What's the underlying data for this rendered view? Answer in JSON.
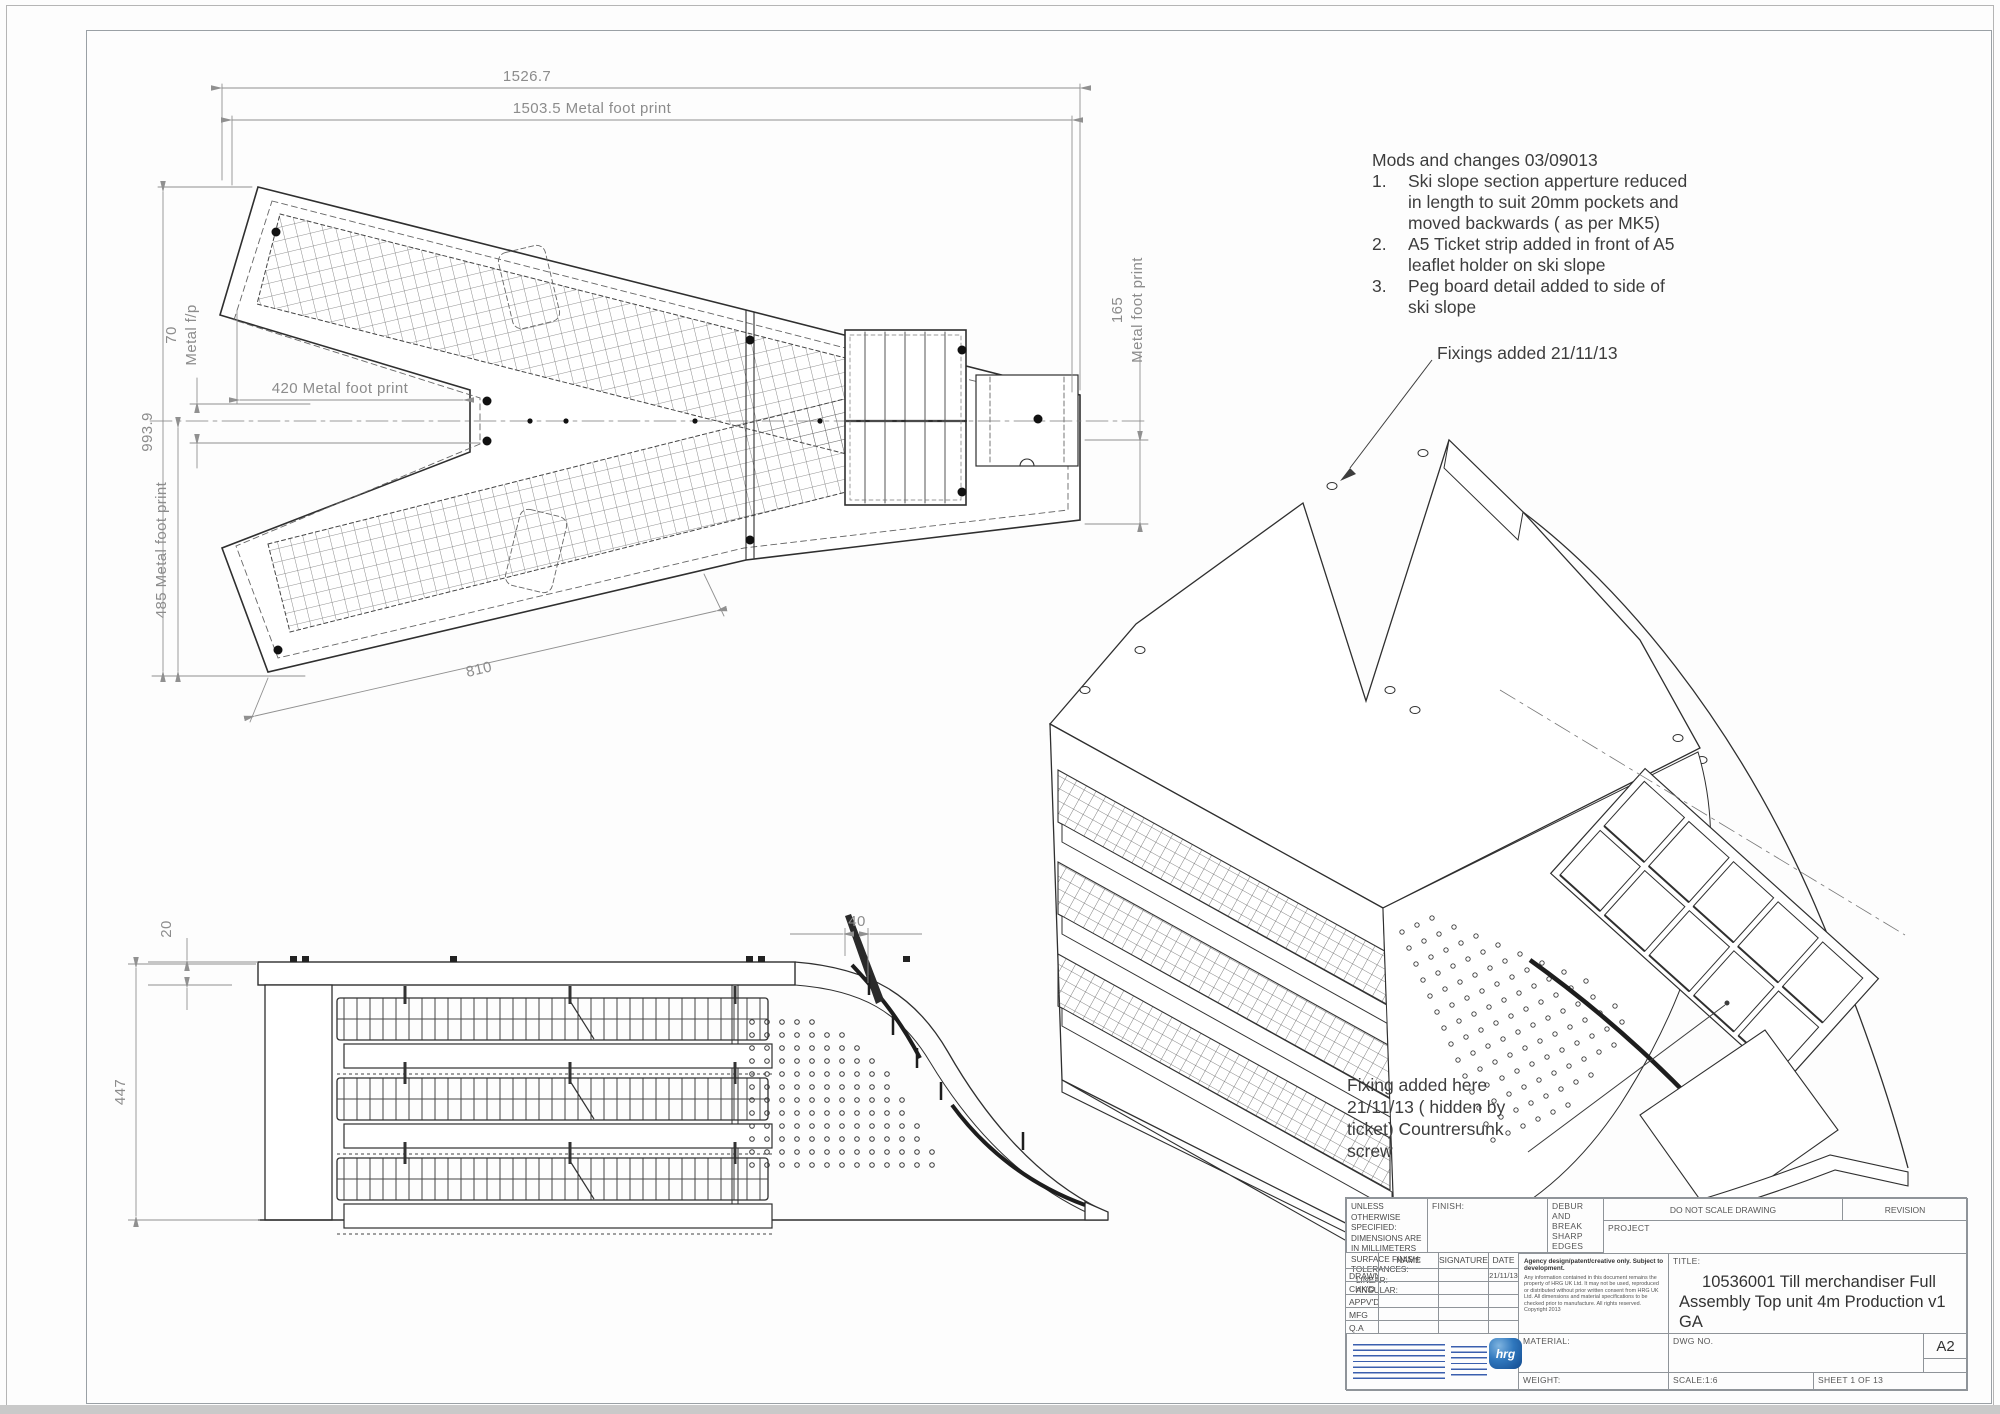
{
  "notes": {
    "title": "Mods and changes 03/09013",
    "items": [
      {
        "n": "1.",
        "text": "Ski slope section apperture reduced in length to suit 20mm pockets and moved backwards ( as per MK5)"
      },
      {
        "n": "2.",
        "text": "A5 Ticket strip added in front of A5 leaflet holder on ski slope"
      },
      {
        "n": "3.",
        "text": "Peg board detail added to side of ski slope"
      }
    ]
  },
  "iso_annotations": {
    "fixings_added": "Fixings added 21/11/13",
    "fixing_added_here_lines": [
      "Fixing added here",
      "21/11/13 ( hidden by",
      "ticket) Countrersunk",
      "screw"
    ]
  },
  "plan_dims": {
    "overall_width": "1526.7",
    "footprint_width": "1503.5 Metal foot print",
    "overall_height": "993.9",
    "notch_offset": "70",
    "notch_offset_unit": "Metal f/p",
    "notch_depth": "420  Metal foot print",
    "arm_footprint": "485 Metal foot print",
    "arm_length": "810",
    "right_width": "165",
    "right_width_unit": "Metal foot print"
  },
  "elev_dims": {
    "top_thickness": "20",
    "height": "447",
    "slope_gap": "40"
  },
  "title_block": {
    "spec_lines": [
      "UNLESS OTHERWISE SPECIFIED:",
      "DIMENSIONS ARE IN MILLIMETERS",
      "SURFACE FINISH:",
      "TOLERANCES:",
      "LINEAR:",
      "ANGULAR:"
    ],
    "finish_label": "FINISH:",
    "debur_text": "DEBUR AND BREAK SHARP EDGES",
    "do_not_scale": "DO NOT SCALE DRAWING",
    "revision_label": "REVISION",
    "project_label": "PROJECT",
    "title_label": "TITLE:",
    "title_value_l1": "10536001 Till merchandiser Full",
    "title_value_l2": "Assembly Top unit 4m Production v1",
    "title_value_l3": "GA",
    "approval": {
      "headers": [
        "NAME",
        "SIGNATURE",
        "DATE"
      ],
      "rows": [
        {
          "label": "DRAWN",
          "date": "21/11/13"
        },
        {
          "label": "CHK'D",
          "date": ""
        },
        {
          "label": "APPV'D",
          "date": ""
        },
        {
          "label": "MFG",
          "date": ""
        },
        {
          "label": "Q.A",
          "date": ""
        }
      ]
    },
    "disclaimer_heading": "Agency design/patent/creative only. Subject to development.",
    "disclaimer_body": "Any information contained in this document remains the property of HRG UK Ltd. It may not be used, reproduced or distributed without prior written consent from HRG UK Ltd. All dimensions and material specifications to be checked prior to manufacture. All rights reserved. Copyright 2013",
    "material_label": "MATERIAL:",
    "weight_label": "WEIGHT:",
    "dwg_no_label": "DWG NO.",
    "paper_size": "A2",
    "scale_label": "SCALE:1:6",
    "sheet_label": "SHEET 1 OF 13",
    "logo_text": "hrg"
  }
}
